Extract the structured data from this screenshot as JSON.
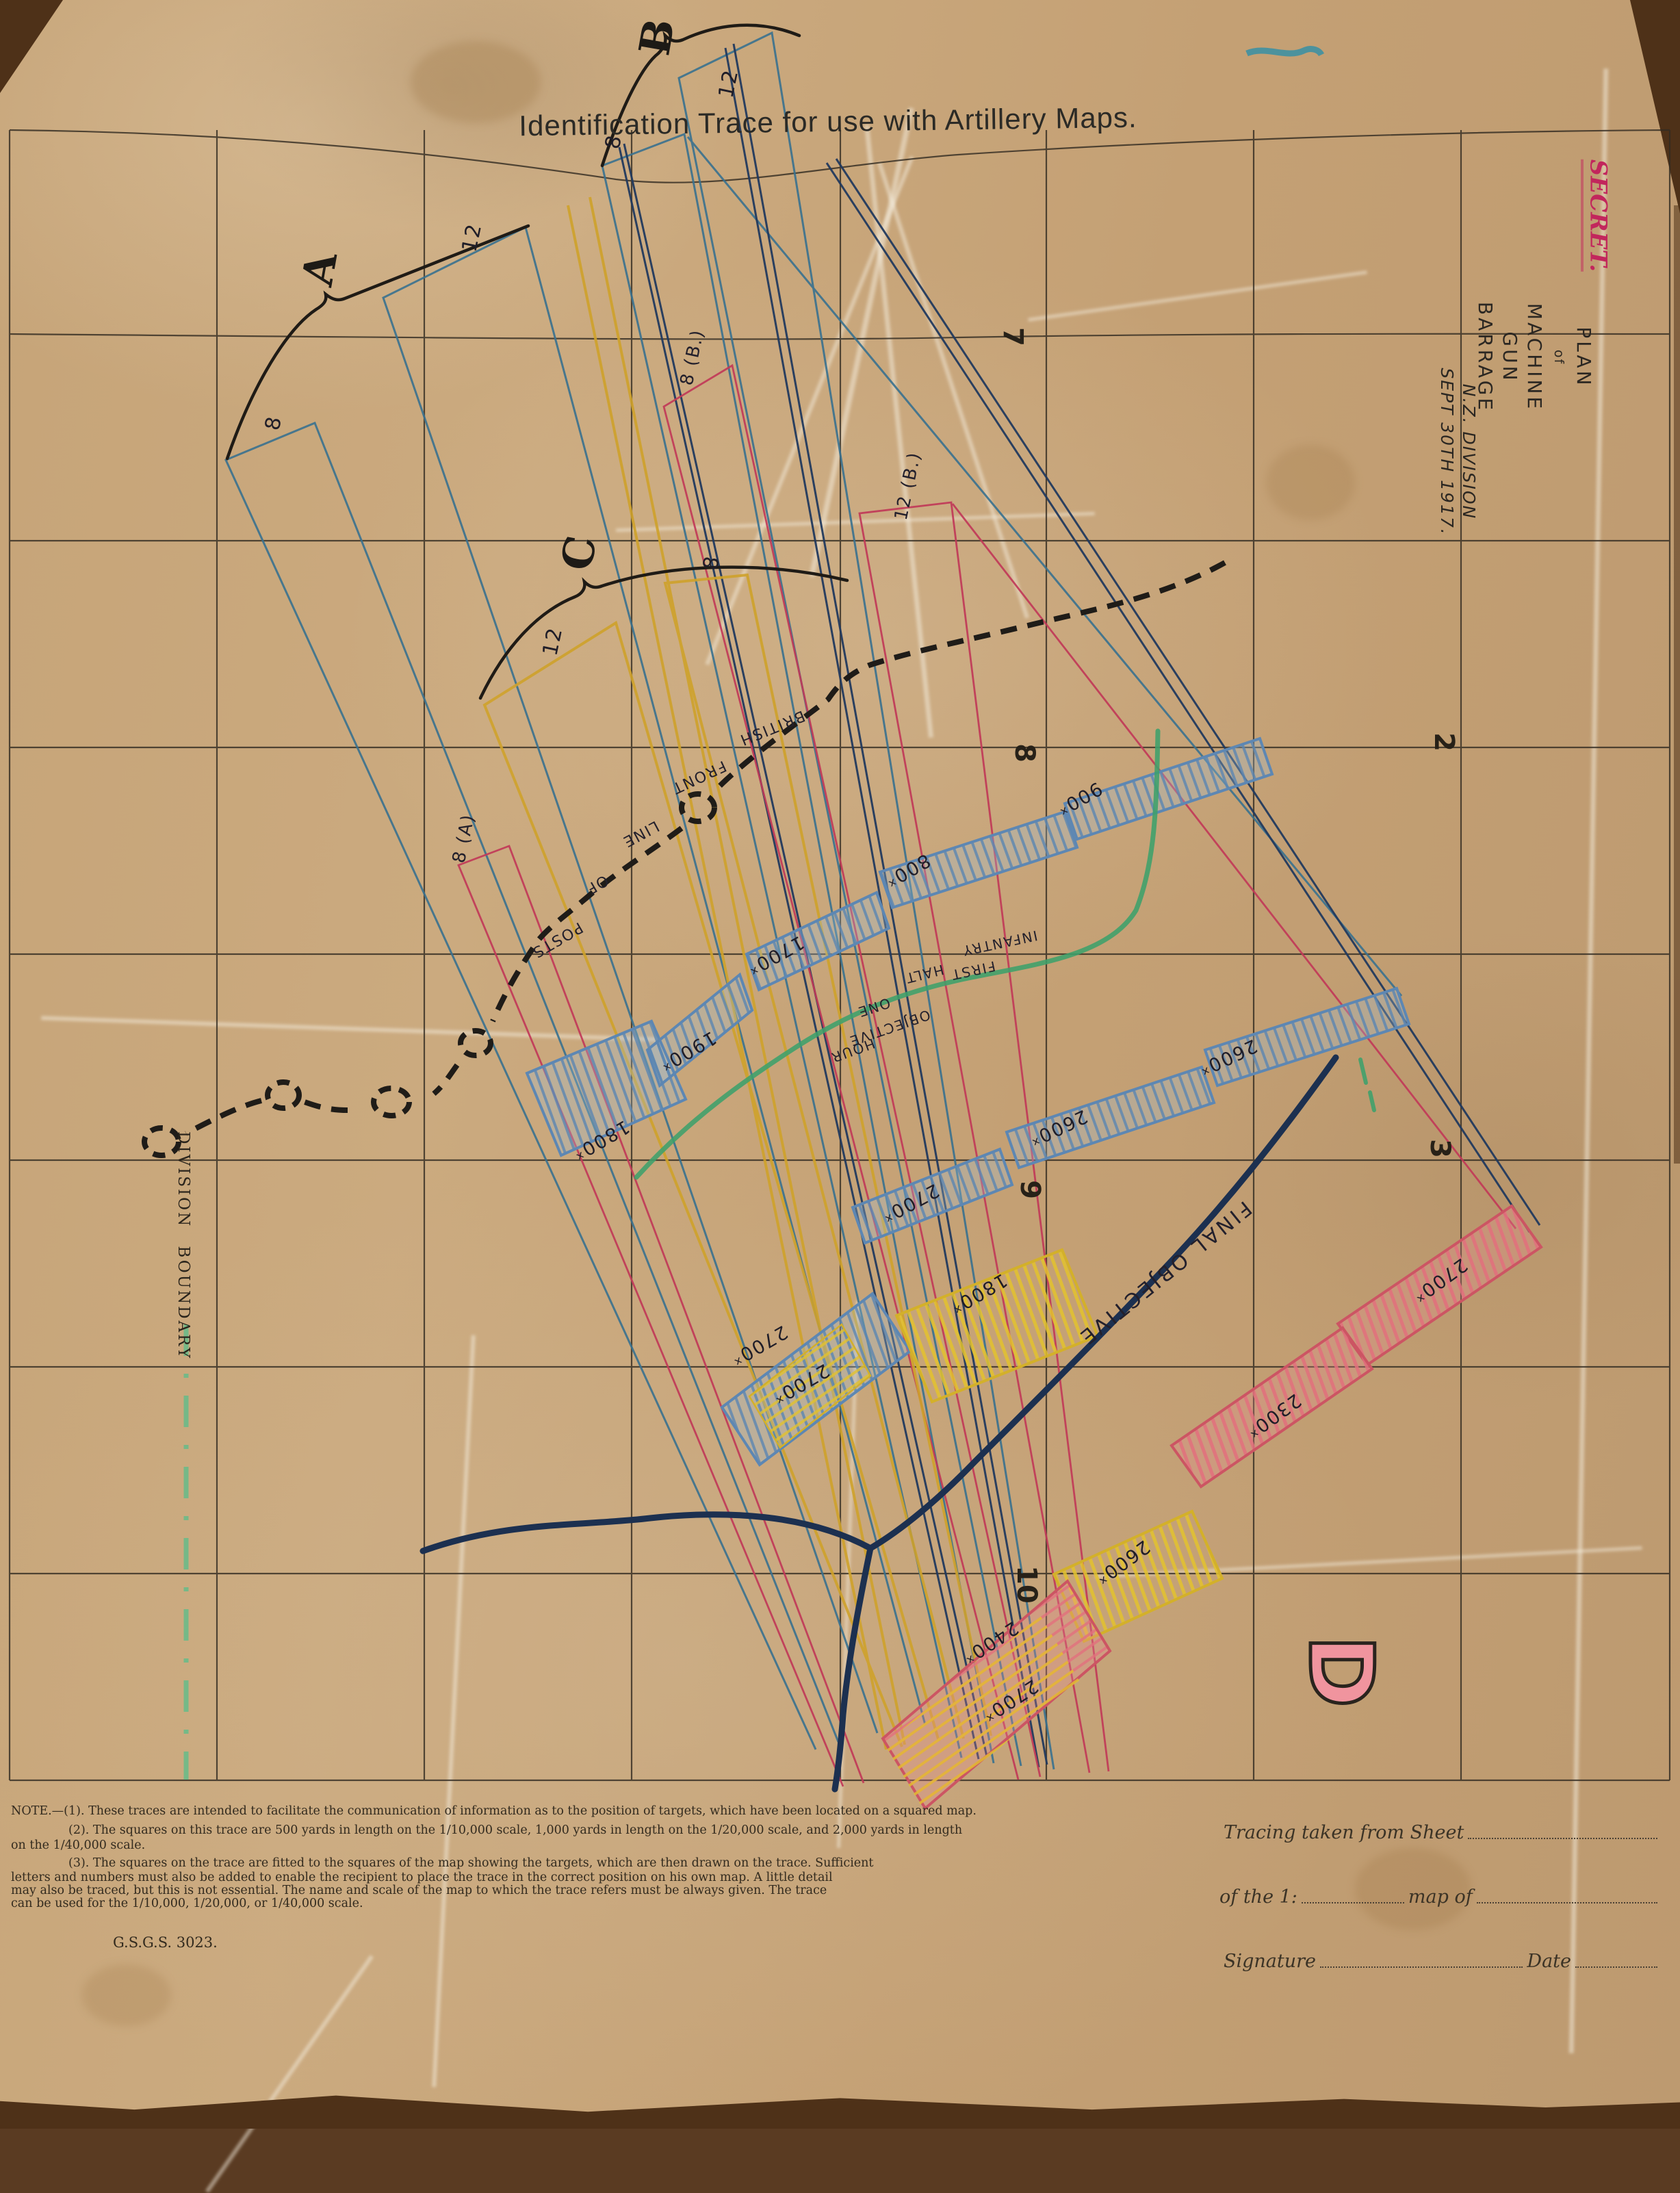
{
  "title": "Identification Trace for use with Artillery Maps.",
  "classification": {
    "secret": "SECRET."
  },
  "margin": {
    "plan1": "PLAN",
    "plan2": "of",
    "plan3": "MACHINE GUN BARRAGE",
    "division": "N.Z. DIVISION",
    "date": "SEPT 30TH 1917."
  },
  "grid_numbers": {
    "n7": "7",
    "n8": "8",
    "n9": "9",
    "n10": "10",
    "n2": "2",
    "n3": "3"
  },
  "group_letters": {
    "a": "A",
    "b": "B",
    "c": "C",
    "d": "D"
  },
  "lane_labels": {
    "a12": "12",
    "a8": "8",
    "b12": "12",
    "b8": "8",
    "c12": "12",
    "c8": "8",
    "rb8": "8 (B.)",
    "rb12": "12 (B.)",
    "ra8": "8 (A)"
  },
  "ranges": {
    "r1": "900ˣ",
    "r2": "800ˣ",
    "r3": "1700ˣ",
    "r4": "1900ˣ",
    "r5": "1800ˣ",
    "r6": "2600ˣ",
    "r7": "2600ˣ",
    "r8": "2700ˣ",
    "r9": "1800ˣ",
    "r10": "2700ˣ",
    "r11": "2700ˣ",
    "r12": "2700ˣ",
    "r13": "2300ˣ",
    "r14": "2600ˣ",
    "r15": "2400ˣ",
    "r16": "2700ˣ"
  },
  "front_line": {
    "w1": "BRITISH",
    "w2": "FRONT",
    "w3": "LINE",
    "w4": "OF",
    "w5": "POSTS"
  },
  "objectives": {
    "w_infantry": "INFANTRY",
    "w_first": "FIRST",
    "w_halt": "HALT",
    "w_one": "ONE",
    "w_hour": "HOUR",
    "w_objective": "OBJECTIVE",
    "final": "FINAL OBJECTIVE"
  },
  "boundary": {
    "label": "DIVISION BOUNDARY"
  },
  "notes": {
    "l1": "NOTE.—(1).  These traces are intended to facilitate the communication of information as to the position of targets, which have been located on a squared map.",
    "l2": "(2).  The squares on this trace are 500 yards in length on the 1/10,000 scale, 1,000 yards in length on the 1/20,000 scale, and 2,000 yards in length",
    "l3": "on the 1/40,000 scale.",
    "l4": "(3).  The squares on the trace are fitted to the squares of the map showing the targets, which are then drawn on the trace.  Sufficient",
    "l5": "letters and numbers must also be added to enable the recipient to place the trace in the correct position on his own map.  A little detail",
    "l6": "may also be traced, but this is not essential.  The name and scale of the map to which the trace refers must be always given.  The trace",
    "l7": "can be used for the 1/10,000, 1/20,000, or 1/40,000 scale.",
    "gsgs": "G.S.G.S. 3023."
  },
  "form": {
    "sheet": "Tracing taken from Sheet",
    "scale": "of the 1:",
    "mapof": "map of",
    "signature": "Signature",
    "date": "Date"
  },
  "colors": {
    "paper": "#c7a67c",
    "ink": "#26211a",
    "blue": "#5b86b2",
    "navy": "#1c3050",
    "red": "#c23a58",
    "yellow": "#d9af2e",
    "green": "#3da06b",
    "secret_red": "#c2265c"
  }
}
